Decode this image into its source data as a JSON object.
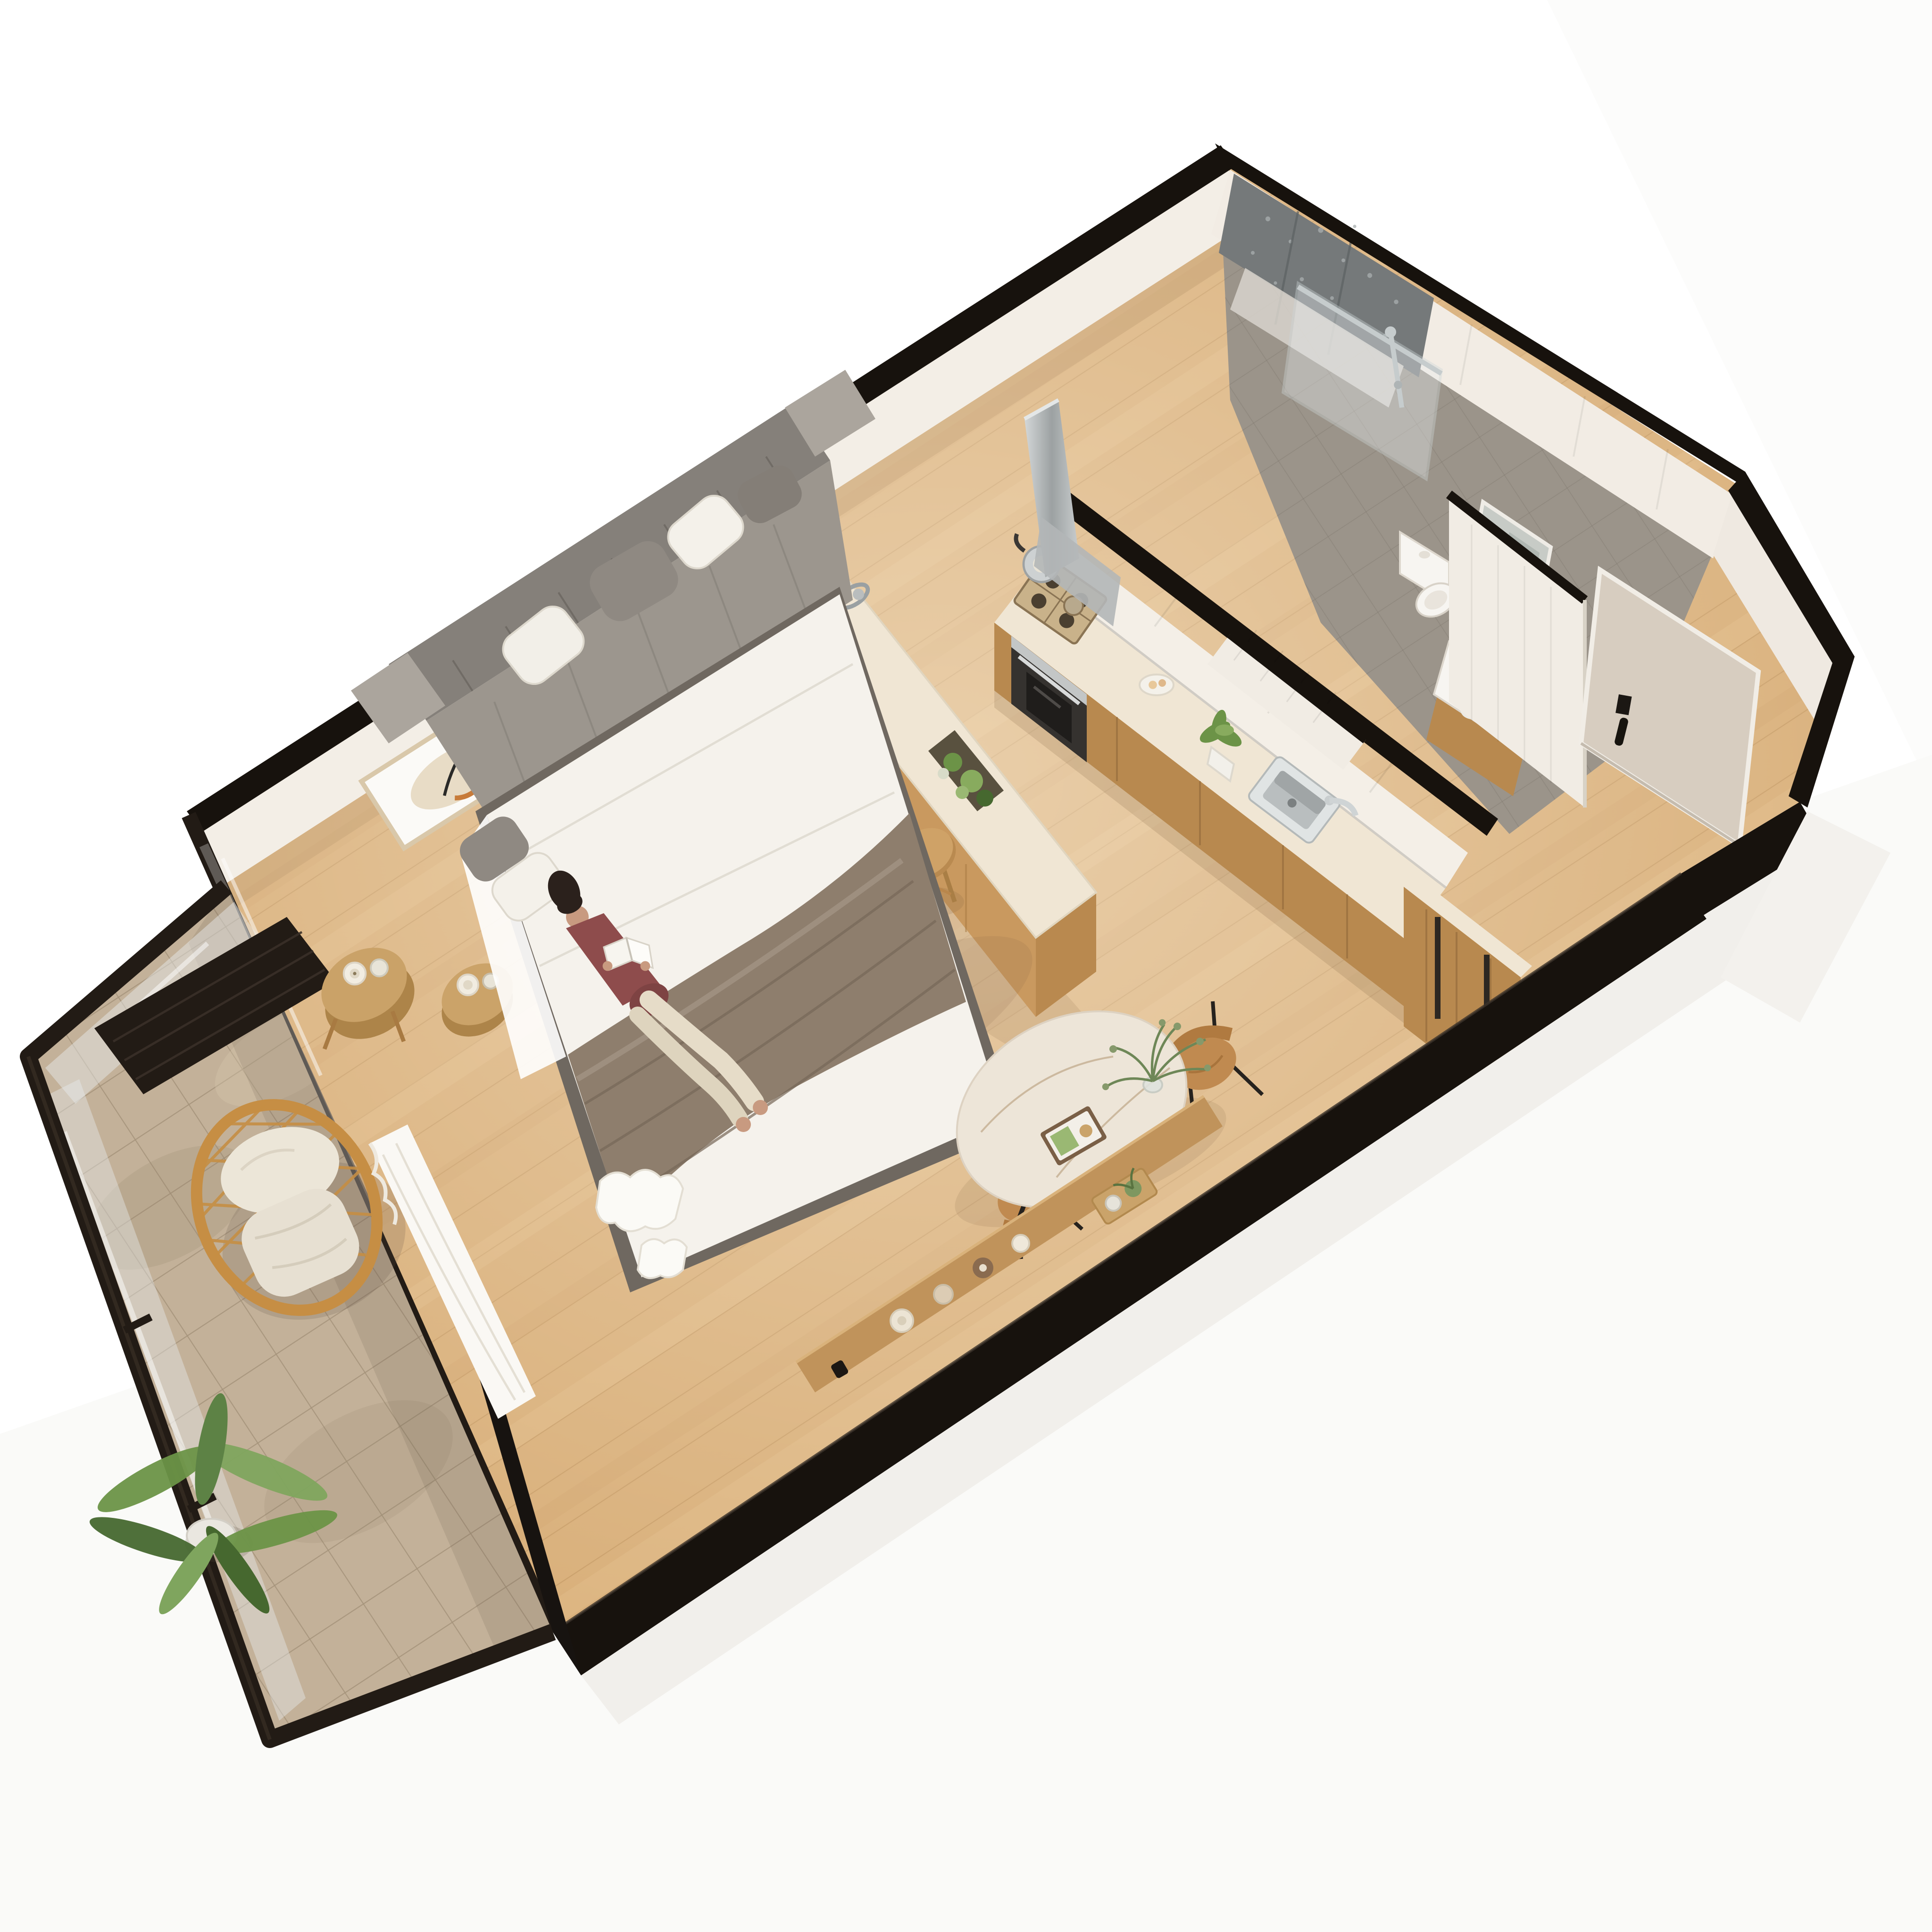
{
  "scene": {
    "type": "3d-isometric-floorplan-render",
    "aria_label": "3D isometric render of a studio apartment floor plan",
    "description": "Cut-away isometric 3D render of a compact studio apartment: open living and sleeping area with a pulled-out grey sofa bed where a woman lies reading, framed abstract art on the wall, a kitchen island with stools, a galley kitchen with hob, oven, hood and sink, a bathroom with walk-in shower, toilet, vanity and mirror, an entry hall with front door, a round marble dining table with two wooden chairs, a low wooden console with candles, and a balcony with a rattan lounge chair and a potted palm."
  },
  "rooms": [
    {
      "name": "living-sleeping-area"
    },
    {
      "name": "kitchen"
    },
    {
      "name": "bathroom"
    },
    {
      "name": "entry-hall"
    },
    {
      "name": "dining-nook"
    },
    {
      "name": "balcony"
    }
  ],
  "furniture": [
    "grey sofa bed with pillows and taupe blanket",
    "woman in maroon top reading a book",
    "framed abstract wall art",
    "round wooden side table with candle and glass",
    "kitchen island with herb planter and metal trivet",
    "two round wooden stools",
    "kitchen counter with gas hob, kettle, built-in oven, range hood and steel sink",
    "white upper cabinets",
    "tall wooden pantry cabinet with black handles",
    "walk-in shower with dark stone wall and glass screen",
    "toilet",
    "vanity basin with chrome tap and tall mirror",
    "white sliding pocket doors",
    "front entry door with black handle",
    "round marble dining table with plant vase and book tray",
    "two bentwood dining chairs with black legs",
    "low wooden console with candles and tray",
    "rattan lounge chair with white cushions",
    "potted palm",
    "balcony side table with candle",
    "white ruffled throw at bed foot"
  ],
  "colors": {
    "bg": "#ffffff",
    "bgTint": "#f6f5f2",
    "wallBlack": "#17120d",
    "wallFace": "#f3eee6",
    "wallShade": "#e4dcd1",
    "floorWood": "#d8ae78",
    "plankShade": "#b98e58",
    "balconyStone": "#c3b199",
    "balconyTile": "#a5937a",
    "railDark": "#221b15",
    "rattan": "#c68e44",
    "cushion": "#ece6d8",
    "green": "#6c9347",
    "greenDark": "#46682f",
    "pot": "#eae7e0",
    "sofa": "#9c968e",
    "sofaDark": "#85807a",
    "sofaLight": "#aba59d",
    "mattress": "#f5f2ec",
    "blanket": "#8e7e6d",
    "blanketDark": "#776858",
    "bedBase": "#6f6860",
    "skin": "#c89a80",
    "hair": "#2b211c",
    "shirt": "#8e4c4c",
    "pants": "#e6dcc8",
    "wood": "#c9995f",
    "woodDark": "#b8894f",
    "counterTop": "#f0e6d4",
    "upperCab": "#f4efe7",
    "steel": "#b9bdbe",
    "steelDark": "#9ca1a2",
    "ovenGlass": "#35322f",
    "sinkSteel": "#c9cdce",
    "bathFloor": "#9b948a",
    "bathWall": "#f2ece4",
    "showerWall": "#75797a",
    "glass": "#e9eef0",
    "chrome": "#c6cccd",
    "fixture": "#f7f5f1",
    "fixtureShade": "#ddd7cd",
    "mirror": "#c7cbc6",
    "pocketDoor": "#f1ece4",
    "doorBeige": "#d7cdc0",
    "handle": "#17140f",
    "tableTop": "#ede5d8",
    "chairWood": "#c08a50",
    "legBlack": "#26221e",
    "consoleWood": "#c0935b",
    "candleCream": "#ece4d4",
    "candleBrown": "#8a6b4f",
    "artFrame": "#d9c8aa",
    "artBeige": "#e8dcc6",
    "artSage": "#b9cfc2",
    "artOrange": "#c77b3a",
    "slab": "#f1efeb"
  }
}
